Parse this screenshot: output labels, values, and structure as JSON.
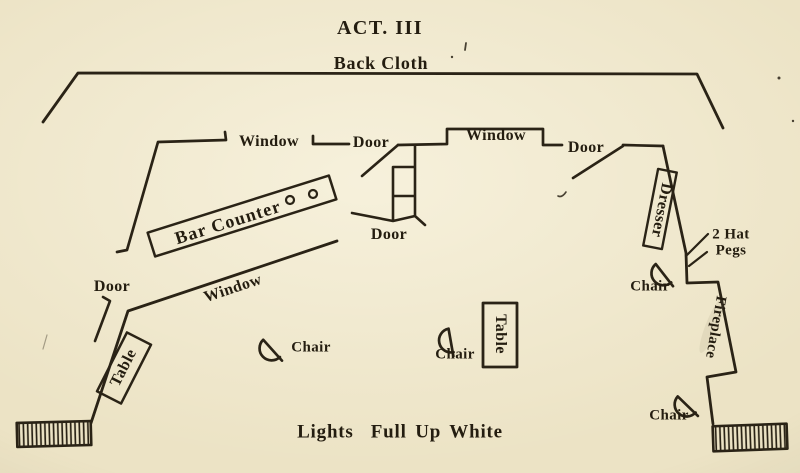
{
  "title": "ACT. III",
  "back_cloth": "Back Cloth",
  "footer": "Lights  Full Up White",
  "labels": {
    "window_upper_left": "Window",
    "door_upper_left": "Door",
    "window_upper_middle": "Window",
    "door_upper_right": "Door",
    "door_stairs": "Door",
    "door_left": "Door",
    "window_left": "Window",
    "bar_counter": "Bar Counter",
    "dresser": "Dresser",
    "hat_pegs_line1": "2 Hat",
    "hat_pegs_line2": "Pegs",
    "fireplace": "Fireplace",
    "table_left": "Table",
    "table_center": "Table",
    "chair_left": "Chair",
    "chair_center": "Chair",
    "chair_dresser": "Chair",
    "chair_fireplace": "Chair"
  },
  "colors": {
    "ink": "#2a2316",
    "text": "#241d10",
    "paper": "#ece3c5"
  }
}
